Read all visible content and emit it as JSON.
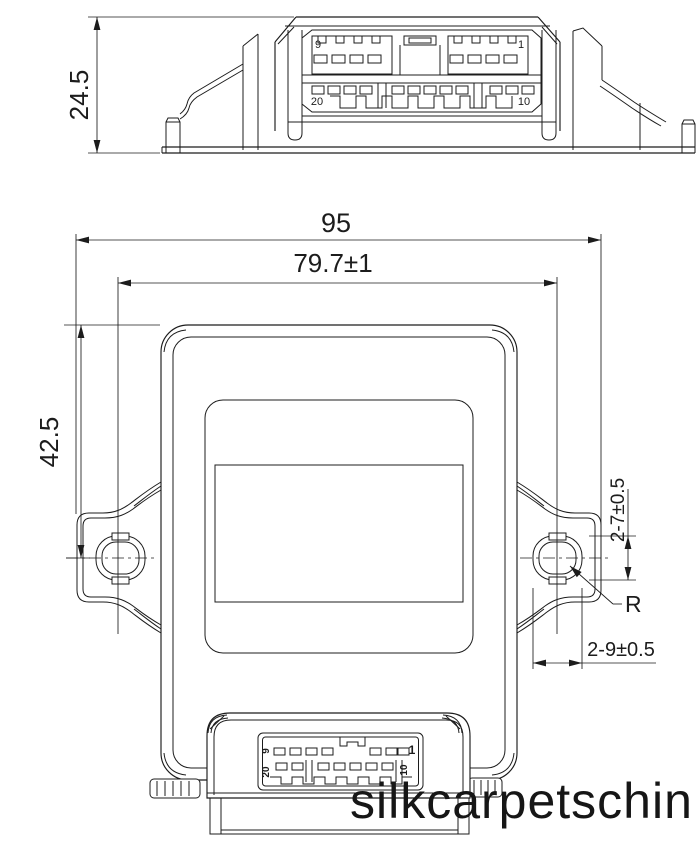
{
  "colors": {
    "ink": "#1c1c1c",
    "background": "#ffffff",
    "watermark": "#161616"
  },
  "watermark": {
    "text": "silkcarpetschin"
  },
  "top_view": {
    "dim_height": "24.5",
    "pins": {
      "top_left": "9",
      "top_right": "1",
      "bottom_left": "20",
      "bottom_right": "10"
    }
  },
  "front_view": {
    "dim_overall_width": "95",
    "dim_hole_spacing": "79.7±1",
    "dim_top_to_hole_center": "42.5",
    "dim_hole_height": "2-7±0.5",
    "dim_hole_width": "2-9±0.5",
    "radius_label": "R",
    "pins": {
      "top_left": "9",
      "top_right": "1",
      "bottom_left": "20",
      "bottom_right": "10"
    }
  }
}
